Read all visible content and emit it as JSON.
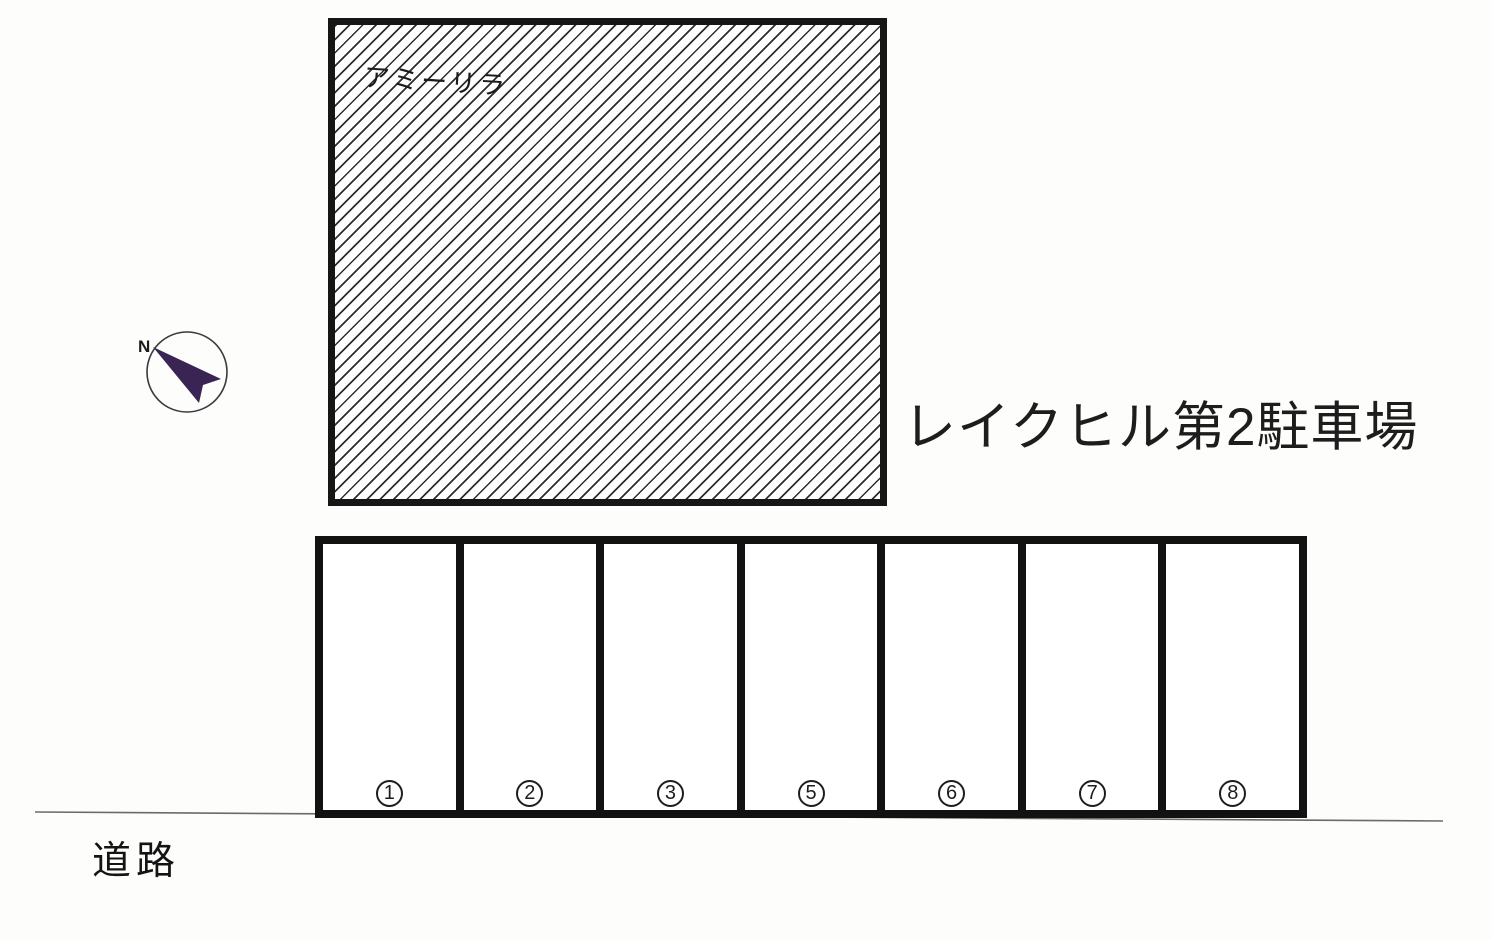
{
  "map": {
    "title": "レイクヒル第2駐車場",
    "building": {
      "label": "アミーリラ",
      "fill_pattern": "diagonal-hatch"
    },
    "compass": {
      "label": "N"
    },
    "road": {
      "label": "道路"
    },
    "parking_row": {
      "spaces": [
        {
          "number": "1"
        },
        {
          "number": "2"
        },
        {
          "number": "3"
        },
        {
          "number": "5"
        },
        {
          "number": "6"
        },
        {
          "number": "7"
        },
        {
          "number": "8"
        }
      ]
    }
  },
  "colors": {
    "line": "#161616",
    "compass_arrow": "#3a2454",
    "background": "#fdfdfc"
  }
}
